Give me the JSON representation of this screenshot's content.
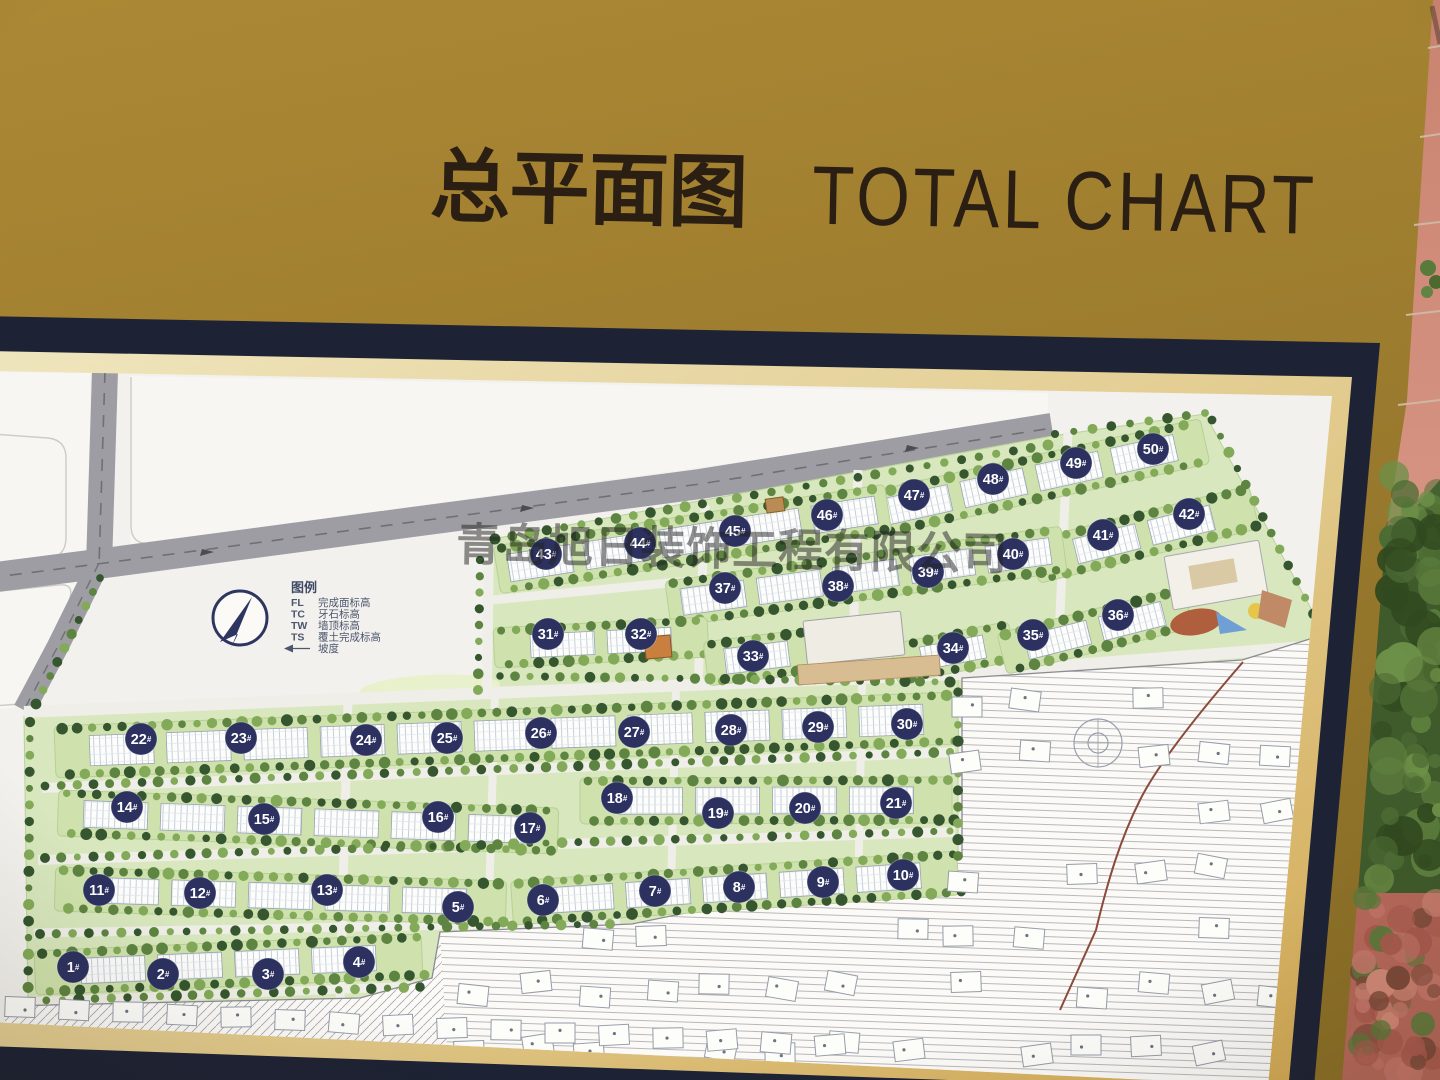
{
  "board": {
    "title_zh": "总平面图",
    "title_en": "TOTAL CHART"
  },
  "watermark": {
    "text": "青岛旭日装饰工程有限公司"
  },
  "legend": {
    "heading": "图例",
    "items": [
      {
        "key": "FL",
        "label": "完成面标高"
      },
      {
        "key": "TC",
        "label": "牙石标高"
      },
      {
        "key": "TW",
        "label": "墙顶标高"
      },
      {
        "key": "TS",
        "label": "覆土完成标高"
      },
      {
        "key": "",
        "label": "坡度",
        "symbol": "slope-arrow"
      }
    ]
  },
  "site_plan": {
    "building_label_suffix": "#",
    "buildings": [
      {
        "n": 1,
        "x": 73,
        "y": 967
      },
      {
        "n": 2,
        "x": 163,
        "y": 974
      },
      {
        "n": 3,
        "x": 268,
        "y": 974
      },
      {
        "n": 4,
        "x": 359,
        "y": 962
      },
      {
        "n": 5,
        "x": 458,
        "y": 907
      },
      {
        "n": 6,
        "x": 543,
        "y": 900
      },
      {
        "n": 7,
        "x": 655,
        "y": 891
      },
      {
        "n": 8,
        "x": 739,
        "y": 887
      },
      {
        "n": 9,
        "x": 823,
        "y": 882
      },
      {
        "n": 10,
        "x": 903,
        "y": 875
      },
      {
        "n": 11,
        "x": 99,
        "y": 890
      },
      {
        "n": 12,
        "x": 200,
        "y": 893
      },
      {
        "n": 13,
        "x": 327,
        "y": 890
      },
      {
        "n": 14,
        "x": 127,
        "y": 807
      },
      {
        "n": 15,
        "x": 264,
        "y": 819
      },
      {
        "n": 16,
        "x": 438,
        "y": 817
      },
      {
        "n": 17,
        "x": 530,
        "y": 828
      },
      {
        "n": 18,
        "x": 617,
        "y": 798
      },
      {
        "n": 19,
        "x": 718,
        "y": 813
      },
      {
        "n": 20,
        "x": 805,
        "y": 808
      },
      {
        "n": 21,
        "x": 896,
        "y": 803
      },
      {
        "n": 22,
        "x": 141,
        "y": 739
      },
      {
        "n": 23,
        "x": 241,
        "y": 738
      },
      {
        "n": 24,
        "x": 366,
        "y": 740
      },
      {
        "n": 25,
        "x": 447,
        "y": 738
      },
      {
        "n": 26,
        "x": 541,
        "y": 733
      },
      {
        "n": 27,
        "x": 634,
        "y": 732
      },
      {
        "n": 28,
        "x": 731,
        "y": 730
      },
      {
        "n": 29,
        "x": 818,
        "y": 727
      },
      {
        "n": 30,
        "x": 907,
        "y": 724
      },
      {
        "n": 31,
        "x": 548,
        "y": 634
      },
      {
        "n": 32,
        "x": 641,
        "y": 634
      },
      {
        "n": 33,
        "x": 753,
        "y": 656
      },
      {
        "n": 34,
        "x": 953,
        "y": 648
      },
      {
        "n": 35,
        "x": 1033,
        "y": 635
      },
      {
        "n": 36,
        "x": 1118,
        "y": 615
      },
      {
        "n": 37,
        "x": 725,
        "y": 588
      },
      {
        "n": 38,
        "x": 838,
        "y": 586
      },
      {
        "n": 39,
        "x": 928,
        "y": 572
      },
      {
        "n": 40,
        "x": 1013,
        "y": 554
      },
      {
        "n": 41,
        "x": 1103,
        "y": 535
      },
      {
        "n": 42,
        "x": 1189,
        "y": 514
      },
      {
        "n": 43,
        "x": 546,
        "y": 554
      },
      {
        "n": 44,
        "x": 640,
        "y": 543
      },
      {
        "n": 45,
        "x": 735,
        "y": 531
      },
      {
        "n": 46,
        "x": 827,
        "y": 515
      },
      {
        "n": 47,
        "x": 914,
        "y": 495
      },
      {
        "n": 48,
        "x": 993,
        "y": 479
      },
      {
        "n": 49,
        "x": 1076,
        "y": 463
      },
      {
        "n": 50,
        "x": 1153,
        "y": 449
      }
    ]
  },
  "colors": {
    "board_gold": "#a08030",
    "title_text": "#2b1e12",
    "frame_navy": "#1d2335",
    "frame_mat": "#ddc27f",
    "map_paper": "#f2f1ed",
    "road_gray": "#9d9da3",
    "greenery": "#cfe2ad",
    "tree_dark": "#35562e",
    "marker_navy": "#2c3160",
    "hatch_gray": "#a7a7ad",
    "wall_salmon": "#cf8a75",
    "bush_green": "#3f5a2b",
    "plant_red": "#b5685a"
  }
}
